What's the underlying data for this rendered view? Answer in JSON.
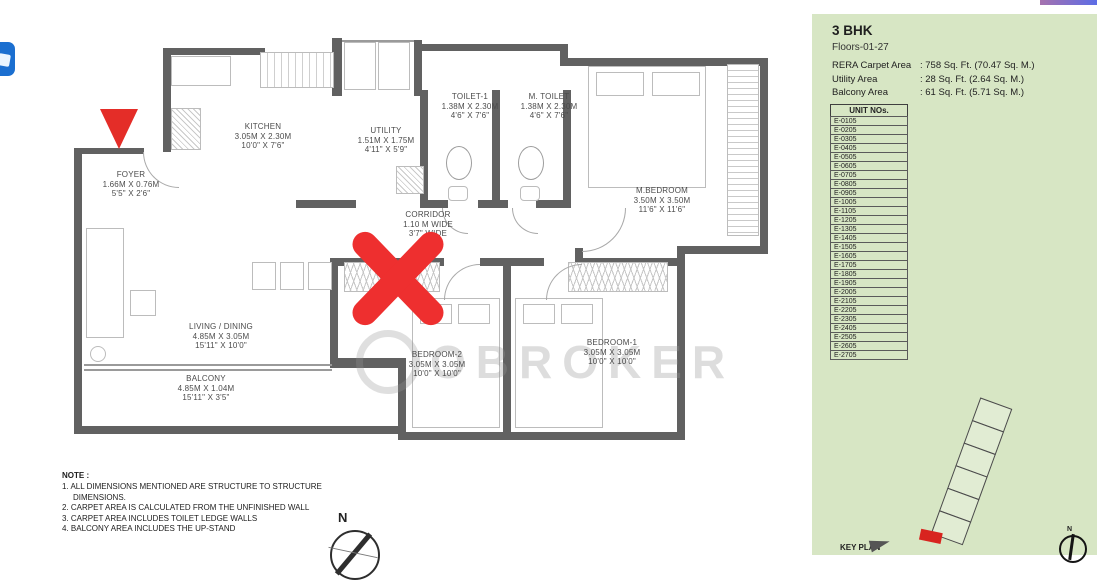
{
  "colors": {
    "panel_green": "#d7e6c4",
    "wall_gray": "#616161",
    "marker_red": "#ea2e2b",
    "icon_blue": "#1b6fd0"
  },
  "plan": {
    "watermark": "OBROKER",
    "compass_label": "N",
    "corridor": {
      "name": "CORRIDOR",
      "line1": "1.10 M WIDE",
      "line2": "3'7\" WIDE"
    },
    "rooms": [
      {
        "name": "FOYER",
        "dim_m": "1.66M X 0.76M",
        "dim_ft": "5'5\" X 2'6\""
      },
      {
        "name": "KITCHEN",
        "dim_m": "3.05M X 2.30M",
        "dim_ft": "10'0\" X 7'6\""
      },
      {
        "name": "UTILITY",
        "dim_m": "1.51M X 1.75M",
        "dim_ft": "4'11\" X 5'9\""
      },
      {
        "name": "TOILET-1",
        "dim_m": "1.38M X 2.30M",
        "dim_ft": "4'6\" X 7'6\""
      },
      {
        "name": "M. TOILET",
        "dim_m": "1.38M X 2.30M",
        "dim_ft": "4'6\" X 7'6\""
      },
      {
        "name": "M.BEDROOM",
        "dim_m": "3.50M X 3.50M",
        "dim_ft": "11'6\" X 11'6\""
      },
      {
        "name": "LIVING / DINING",
        "dim_m": "4.85M X 3.05M",
        "dim_ft": "15'11\" X 10'0\""
      },
      {
        "name": "BALCONY",
        "dim_m": "4.85M X 1.04M",
        "dim_ft": "15'11\" X 3'5\""
      },
      {
        "name": "BEDROOM-2",
        "dim_m": "3.05M X 3.05M",
        "dim_ft": "10'0\" X 10'0\""
      },
      {
        "name": "BEDROOM-1",
        "dim_m": "3.05M X 3.05M",
        "dim_ft": "10'0\" X 10'0\""
      }
    ]
  },
  "notes": {
    "heading": "NOTE :",
    "items": [
      "1. ALL DIMENSIONS MENTIONED ARE STRUCTURE TO STRUCTURE DIMENSIONS.",
      "2. CARPET AREA IS CALCULATED FROM THE UNFINISHED WALL",
      "3. CARPET AREA INCLUDES TOILET LEDGE WALLS",
      "4. BALCONY AREA INCLUDES THE UP-STAND"
    ]
  },
  "panel": {
    "title": "3 BHK",
    "floors": "Floors-01-27",
    "areas": [
      {
        "label": "RERA Carpet Area",
        "value": ": 758 Sq. Ft. (70.47 Sq. M.)"
      },
      {
        "label": "Utility Area",
        "value": ": 28 Sq. Ft. (2.64 Sq. M.)"
      },
      {
        "label": "Balcony Area",
        "value": ": 61 Sq. Ft. (5.71 Sq. M.)"
      }
    ],
    "unit_table": {
      "header": "UNIT NOs.",
      "rows": [
        "E-0105",
        "E-0205",
        "E-0305",
        "E-0405",
        "E-0505",
        "E-0605",
        "E-0705",
        "E-0805",
        "E-0905",
        "E-1005",
        "E-1105",
        "E-1205",
        "E-1305",
        "E-1405",
        "E-1505",
        "E-1605",
        "E-1705",
        "E-1805",
        "E-1905",
        "E-2005",
        "E-2105",
        "E-2205",
        "E-2305",
        "E-2405",
        "E-2505",
        "E-2605",
        "E-2705"
      ]
    },
    "key_plan_label": "KEY PLAN",
    "compass_label": "N"
  }
}
